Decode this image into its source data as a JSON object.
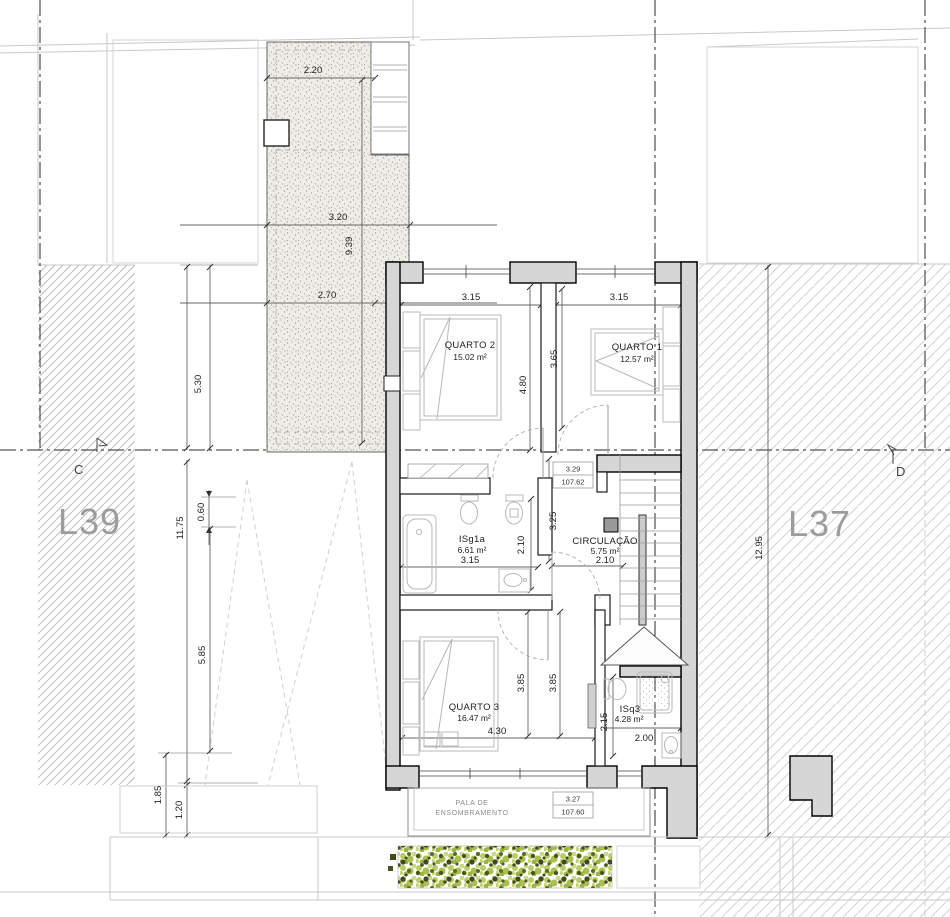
{
  "drawing": {
    "lots": {
      "left": "L39",
      "right": "L37"
    },
    "section_markers": {
      "left": "C",
      "right": "D"
    },
    "rooms": {
      "quarto2": {
        "name": "QUARTO 2",
        "area": "15.02 m²",
        "width": "3.15",
        "depth": "4.80"
      },
      "quarto1": {
        "name": "QUARTO 1",
        "area": "12.57 m²",
        "width": "3.15",
        "depth": "3.65"
      },
      "isg1a": {
        "name": "ISg1a",
        "area": "6.61 m²",
        "width": "3.15",
        "depth": "2.10"
      },
      "circulacao": {
        "name": "CIRCULAÇÃO",
        "area": "5.75 m²",
        "width": "2.10",
        "depth": "3.25"
      },
      "quarto3": {
        "name": "QUARTO 3",
        "area": "16.47 m²",
        "width": "4.30",
        "depth_a": "3.85",
        "depth_b": "3.85"
      },
      "isq3": {
        "name": "ISq3",
        "area": "4.28 m²",
        "width": "2.00",
        "depth": "2.15"
      }
    },
    "site_dimensions": {
      "terrace_top_width": "2.20",
      "terrace_width": "3.20",
      "terrace_length": "9.39",
      "terrace_lower_width": "2.70",
      "left_upper": "5.30",
      "left_total": "11.75",
      "left_offset": "0.60",
      "left_lower": "5.85",
      "bottom_left_a": "1.85",
      "bottom_left_b": "1.20",
      "right_total": "12.95"
    },
    "levels": {
      "floor": {
        "relative": "3.29",
        "absolute": "107.62"
      },
      "canopy": {
        "relative": "3.27",
        "absolute": "107.60"
      }
    },
    "canopy": {
      "line1": "PALA DE",
      "line2": "ENSOMBRAMENTO"
    },
    "colors": {
      "wall_fill": "#d6d6d6",
      "lot_label": "#9c9c9c",
      "hedge_light": "#b7ce62",
      "hedge_dark": "#46511f"
    }
  }
}
